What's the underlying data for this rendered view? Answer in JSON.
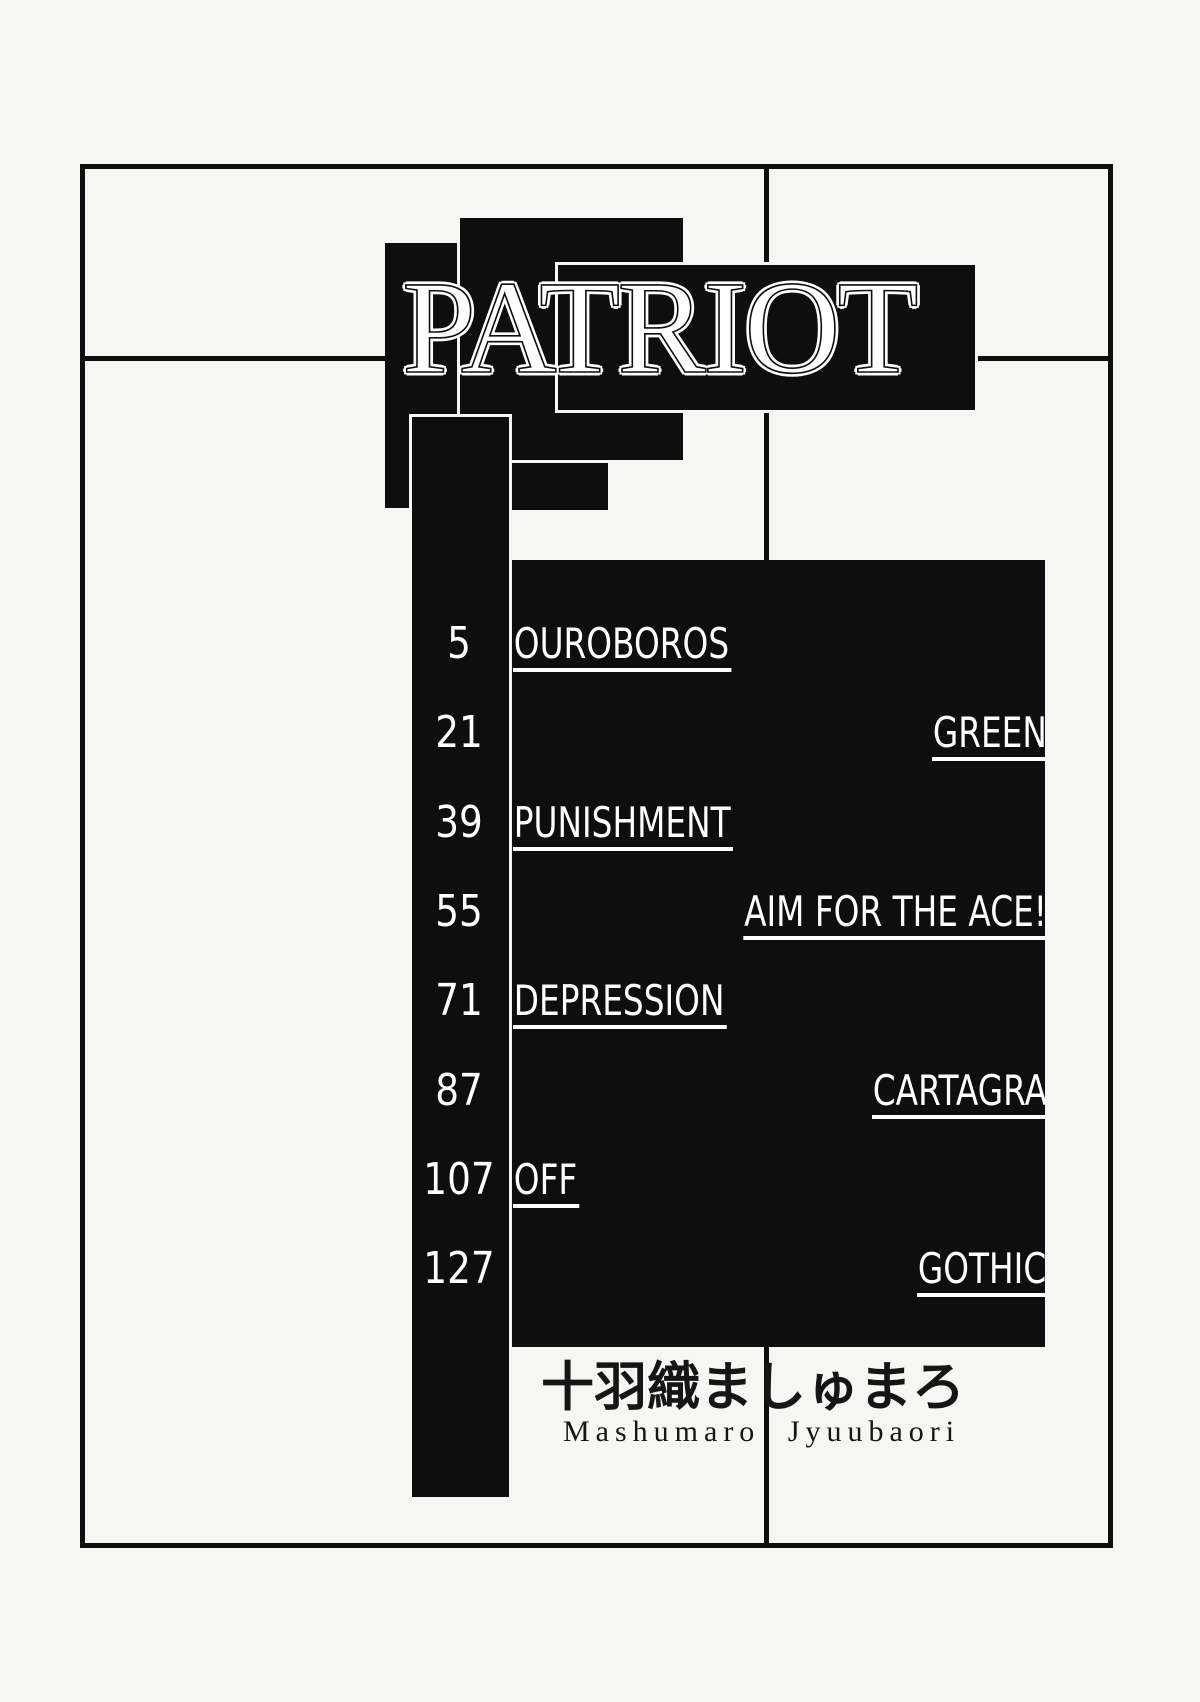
{
  "page": {
    "title": "PATRIOT"
  },
  "toc": {
    "rows": [
      {
        "page": "5",
        "title": "OUROBOROS"
      },
      {
        "page": "21",
        "title": "GREEN"
      },
      {
        "page": "39",
        "title": "PUNISHMENT"
      },
      {
        "page": "55",
        "title": "AIM FOR THE ACE!"
      },
      {
        "page": "71",
        "title": "DEPRESSION"
      },
      {
        "page": "87",
        "title": "CARTAGRA"
      },
      {
        "page": "107",
        "title": "OFF"
      },
      {
        "page": "127",
        "title": "GOTHIC"
      }
    ]
  },
  "author": {
    "name_japanese": "十羽織ましゅまろ",
    "name_romaji_first": "Mashumaro",
    "name_romaji_last": "Jyuubaori"
  },
  "colors": {
    "ink": "#0e0e0e",
    "paper": "#f6f6f3"
  }
}
